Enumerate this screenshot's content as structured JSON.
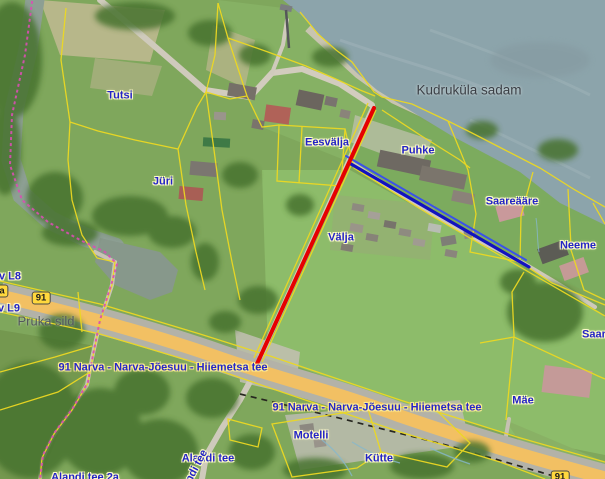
{
  "map": {
    "description": "Aerial cadastral web-map view (Estonian land board style), Kudruküla area",
    "labels": [
      {
        "text": "Tutsi",
        "x": 120,
        "y": 96,
        "cls": "parcel"
      },
      {
        "text": "Jüri",
        "x": 163,
        "y": 182,
        "cls": "parcel"
      },
      {
        "text": "Eesvälja",
        "x": 327,
        "y": 143,
        "cls": "parcel"
      },
      {
        "text": "Puhke",
        "x": 418,
        "y": 151,
        "cls": "parcel"
      },
      {
        "text": "Välja",
        "x": 341,
        "y": 238,
        "cls": "parcel"
      },
      {
        "text": "Saareääre",
        "x": 512,
        "y": 202,
        "cls": "parcel"
      },
      {
        "text": "Neeme",
        "x": 578,
        "y": 246,
        "cls": "parcel"
      },
      {
        "text": "Saare",
        "x": 597,
        "y": 335,
        "cls": "parcel"
      },
      {
        "text": "Mäe",
        "x": 523,
        "y": 401,
        "cls": "parcel"
      },
      {
        "text": "Motelli",
        "x": 311,
        "y": 436,
        "cls": "parcel"
      },
      {
        "text": "Kütte",
        "x": 379,
        "y": 459,
        "cls": "parcel"
      },
      {
        "text": "Alandi tee",
        "x": 208,
        "y": 459,
        "cls": "parcel"
      },
      {
        "text": "Alandi tee",
        "x": 193,
        "y": 474,
        "cls": "parcel",
        "rot": -62
      },
      {
        "text": "Alandi tee 2a",
        "x": 85,
        "y": 478,
        "cls": "parcel"
      },
      {
        "text": "v L8",
        "x": 10,
        "y": 277,
        "cls": "parcel"
      },
      {
        "text": "v L9",
        "x": 9,
        "y": 309,
        "cls": "parcel"
      },
      {
        "text": "Kudruküla sadam",
        "x": 469,
        "y": 90,
        "cls": "place"
      },
      {
        "text": "Pruka sild",
        "x": 46,
        "y": 321,
        "cls": "place-light"
      },
      {
        "text": "91 Narva - Narva-Jõesuu - Hiiemetsa tee",
        "x": 163,
        "y": 368,
        "cls": "road"
      },
      {
        "text": "91 Narva - Narva-Jõesuu - Hiiemetsa tee",
        "x": 377,
        "y": 408,
        "cls": "road"
      }
    ],
    "road_badges": [
      {
        "text": "91",
        "x": 41,
        "y": 298
      },
      {
        "text": "91",
        "x": 560,
        "y": 477
      },
      {
        "text": "a",
        "x": 2,
        "y": 291
      }
    ],
    "overlays": {
      "red_line": {
        "x1": 374,
        "y1": 108,
        "x2": 256,
        "y2": 366,
        "color": "#e60000",
        "width": 4
      },
      "blue_line_main": {
        "x1": 351,
        "y1": 164,
        "x2": 529,
        "y2": 267,
        "color": "#1212c0",
        "width": 3.2
      },
      "blue_line_secondary": {
        "x1": 346,
        "y1": 156,
        "x2": 526,
        "y2": 260,
        "color": "#3a52e8",
        "width": 2
      }
    },
    "colors": {
      "cadastral_boundary_yellow": "#ecd822",
      "municipal_boundary_magenta": "#d94fb3",
      "highway_fill_orange": "#f2c063",
      "water_gray_blue": "#8ca4ab",
      "label_blue": "#2323c6",
      "badge_yellow": "#ffd83d"
    }
  }
}
